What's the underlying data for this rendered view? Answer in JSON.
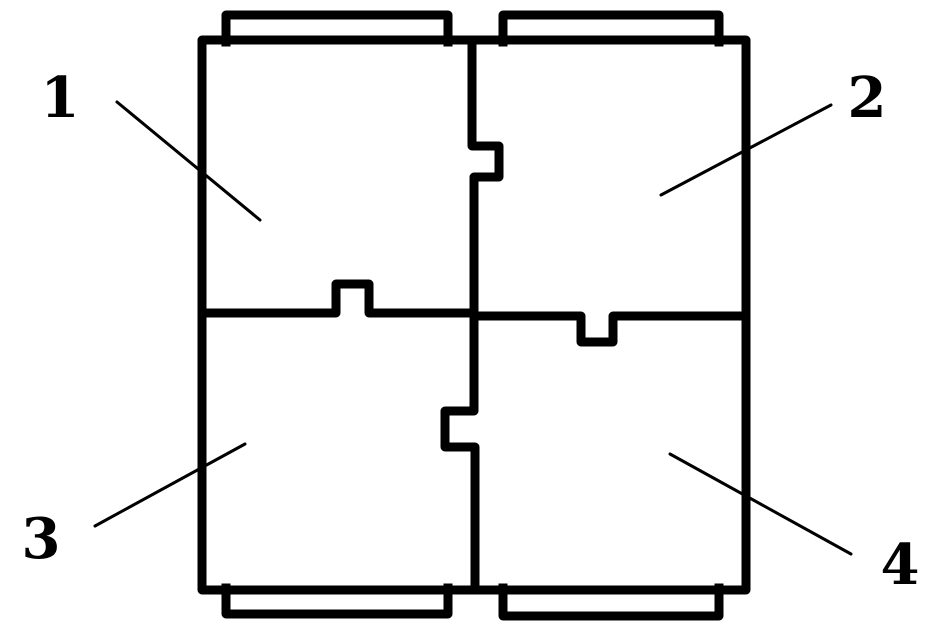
{
  "figure": {
    "background_color": "#ffffff",
    "ink_color": "#000000",
    "labels": [
      {
        "ref": "1",
        "points_to": "top-left-panel"
      },
      {
        "ref": "2",
        "points_to": "top-right-panel"
      },
      {
        "ref": "3",
        "points_to": "bottom-left-panel"
      },
      {
        "ref": "4",
        "points_to": "bottom-right-panel"
      }
    ]
  }
}
